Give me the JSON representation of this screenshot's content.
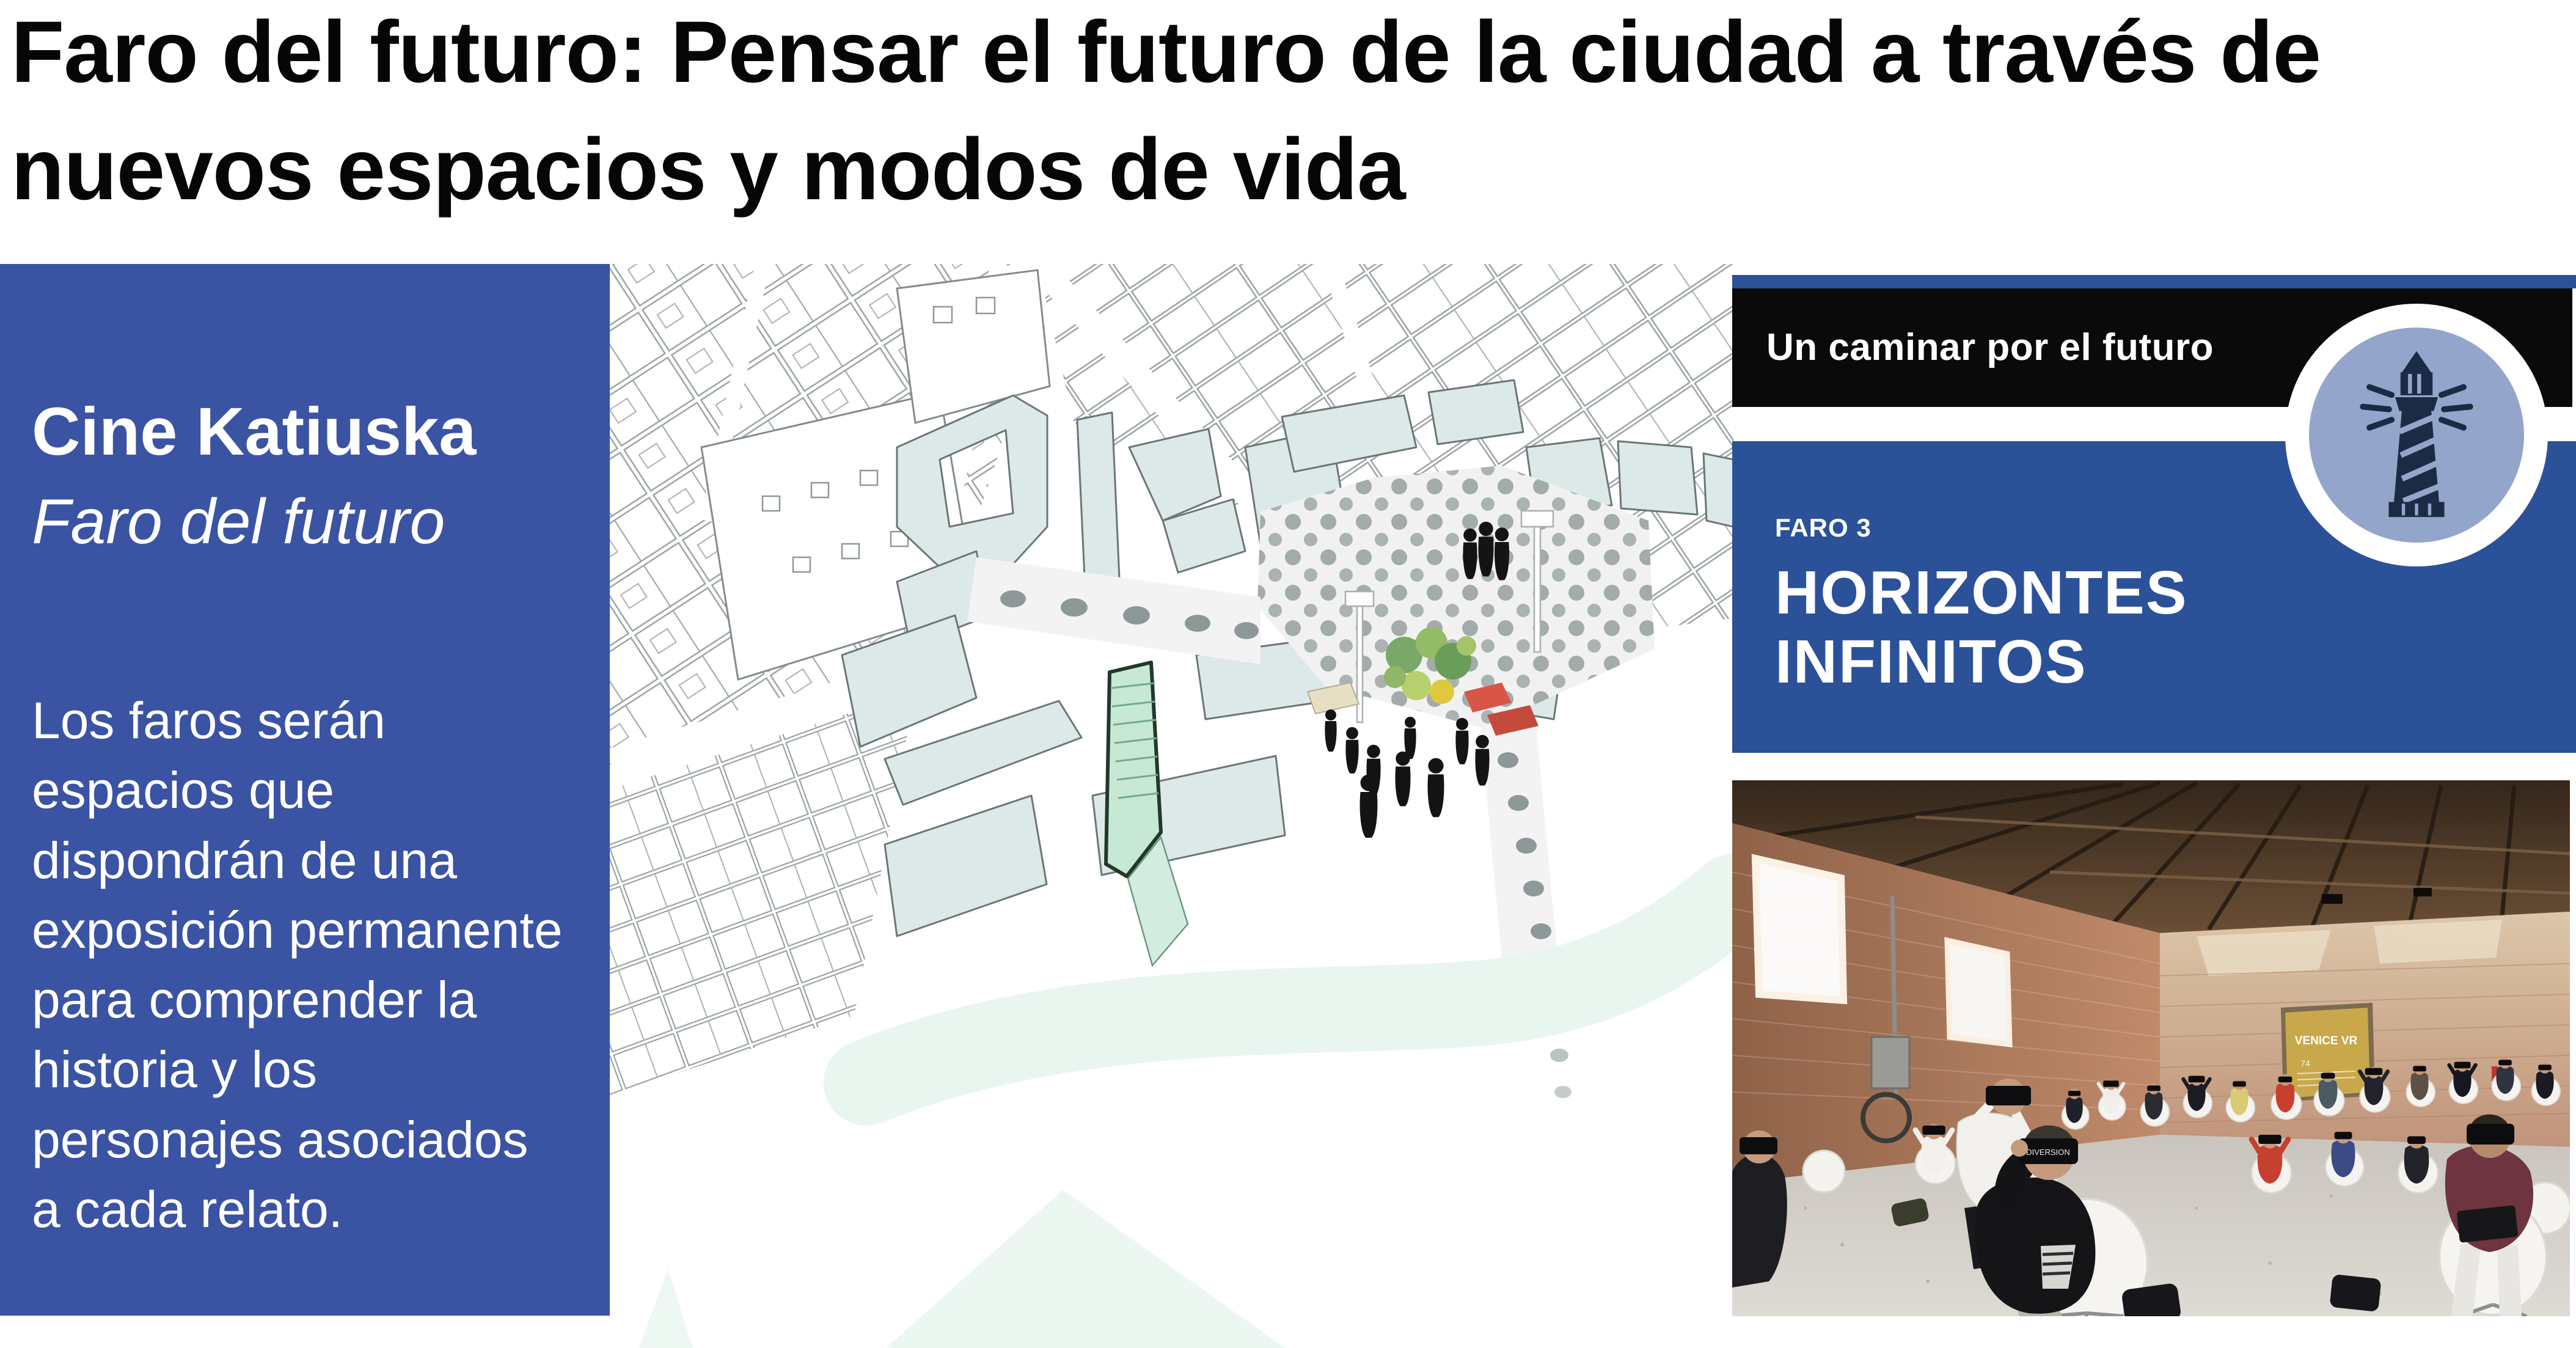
{
  "page": {
    "background": "#ffffff"
  },
  "title": {
    "text": "Faro del futuro: Pensar el futuro de la ciudad a través de\nnuevos espacios y modos de vida"
  },
  "left_panel": {
    "bg_color": "#3B53A3",
    "heading": "Cine Katiuska",
    "subtitle": "Faro del futuro",
    "body": "Los faros serán\nespacios que\ndispondrán de una\nexposición permanente\npara comprender la\nhistoria y los\npersonajes asociados\na cada relato."
  },
  "map": {
    "kind": "axonometric-city-plan",
    "building_fill": "#DDE9E9",
    "highlight_fill": "#C6E8D4",
    "plaza_fill": "#F1F1F1",
    "river_fill": "#E9F6F0"
  },
  "right_panel": {
    "top_bar": {
      "label": "Un caminar por el futuro",
      "bg_color": "#0A0A0B",
      "accent_strip_color": "#2B5198"
    },
    "badge": {
      "icon": "lighthouse-icon",
      "circle_fill": "#93A5CB",
      "icon_color": "#1C2B45"
    },
    "faro_box": {
      "bg_color": "#2B5198",
      "kicker": "FARO 3",
      "title": "HORIZONTES\nINFINITOS"
    },
    "photo": {
      "sign_title": "VENICE VR",
      "sign_badge": "74",
      "headset_label": "DIVERSION"
    }
  }
}
